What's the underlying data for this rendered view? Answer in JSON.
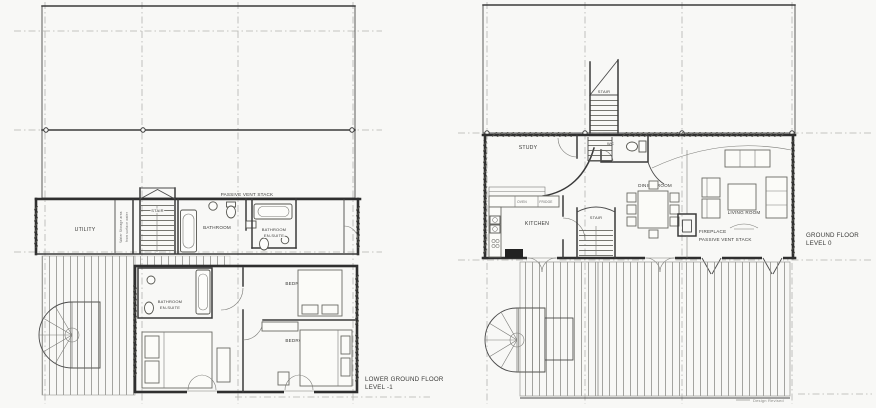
{
  "document": {
    "kind": "architectural-floor-plans",
    "colors": {
      "paper": "#f8f8f6",
      "ink": "#3a3a3a",
      "grid": "#b3b3af",
      "deck_stripe": "#8a8a86"
    }
  },
  "lower_ground_floor": {
    "title_lines": [
      "LOWER GROUND FLOOR",
      "LEVEL -1"
    ],
    "labels": {
      "passive_vent_stack": "PASSIVE VENT STACK",
      "utility": "UTILITY",
      "water_storage_lines": [
        "Water Storage area",
        "from surface water"
      ],
      "stair": "STAIR",
      "bathroom": "BATHROOM",
      "bathroom_ensuite_upper": [
        "BATHROOM",
        "EN-SUITE"
      ],
      "bathroom_ensuite_lower": [
        "BATHROOM",
        "EN-SUITE"
      ],
      "bedroom_1": "BEDROOM 1",
      "bedroom_2": "BEDROOM 2",
      "bedroom_3": "BEDROOM 3"
    }
  },
  "ground_floor": {
    "title_lines": [
      "GROUND FLOOR",
      "LEVEL 0"
    ],
    "labels": {
      "external_stair": "STAIR",
      "study": "STUDY",
      "wc": "WC",
      "kitchen": "KITCHEN",
      "oven": "OVEN",
      "fridge": "FRIDGE",
      "stair": "STAIR",
      "dining_room": "DINING ROOM",
      "living_room": "LIVING ROOM",
      "fireplace": "FIREPLACE",
      "passive_vent_stack": "PASSIVE VENT STACK"
    },
    "revision_note": "Design Revised"
  }
}
